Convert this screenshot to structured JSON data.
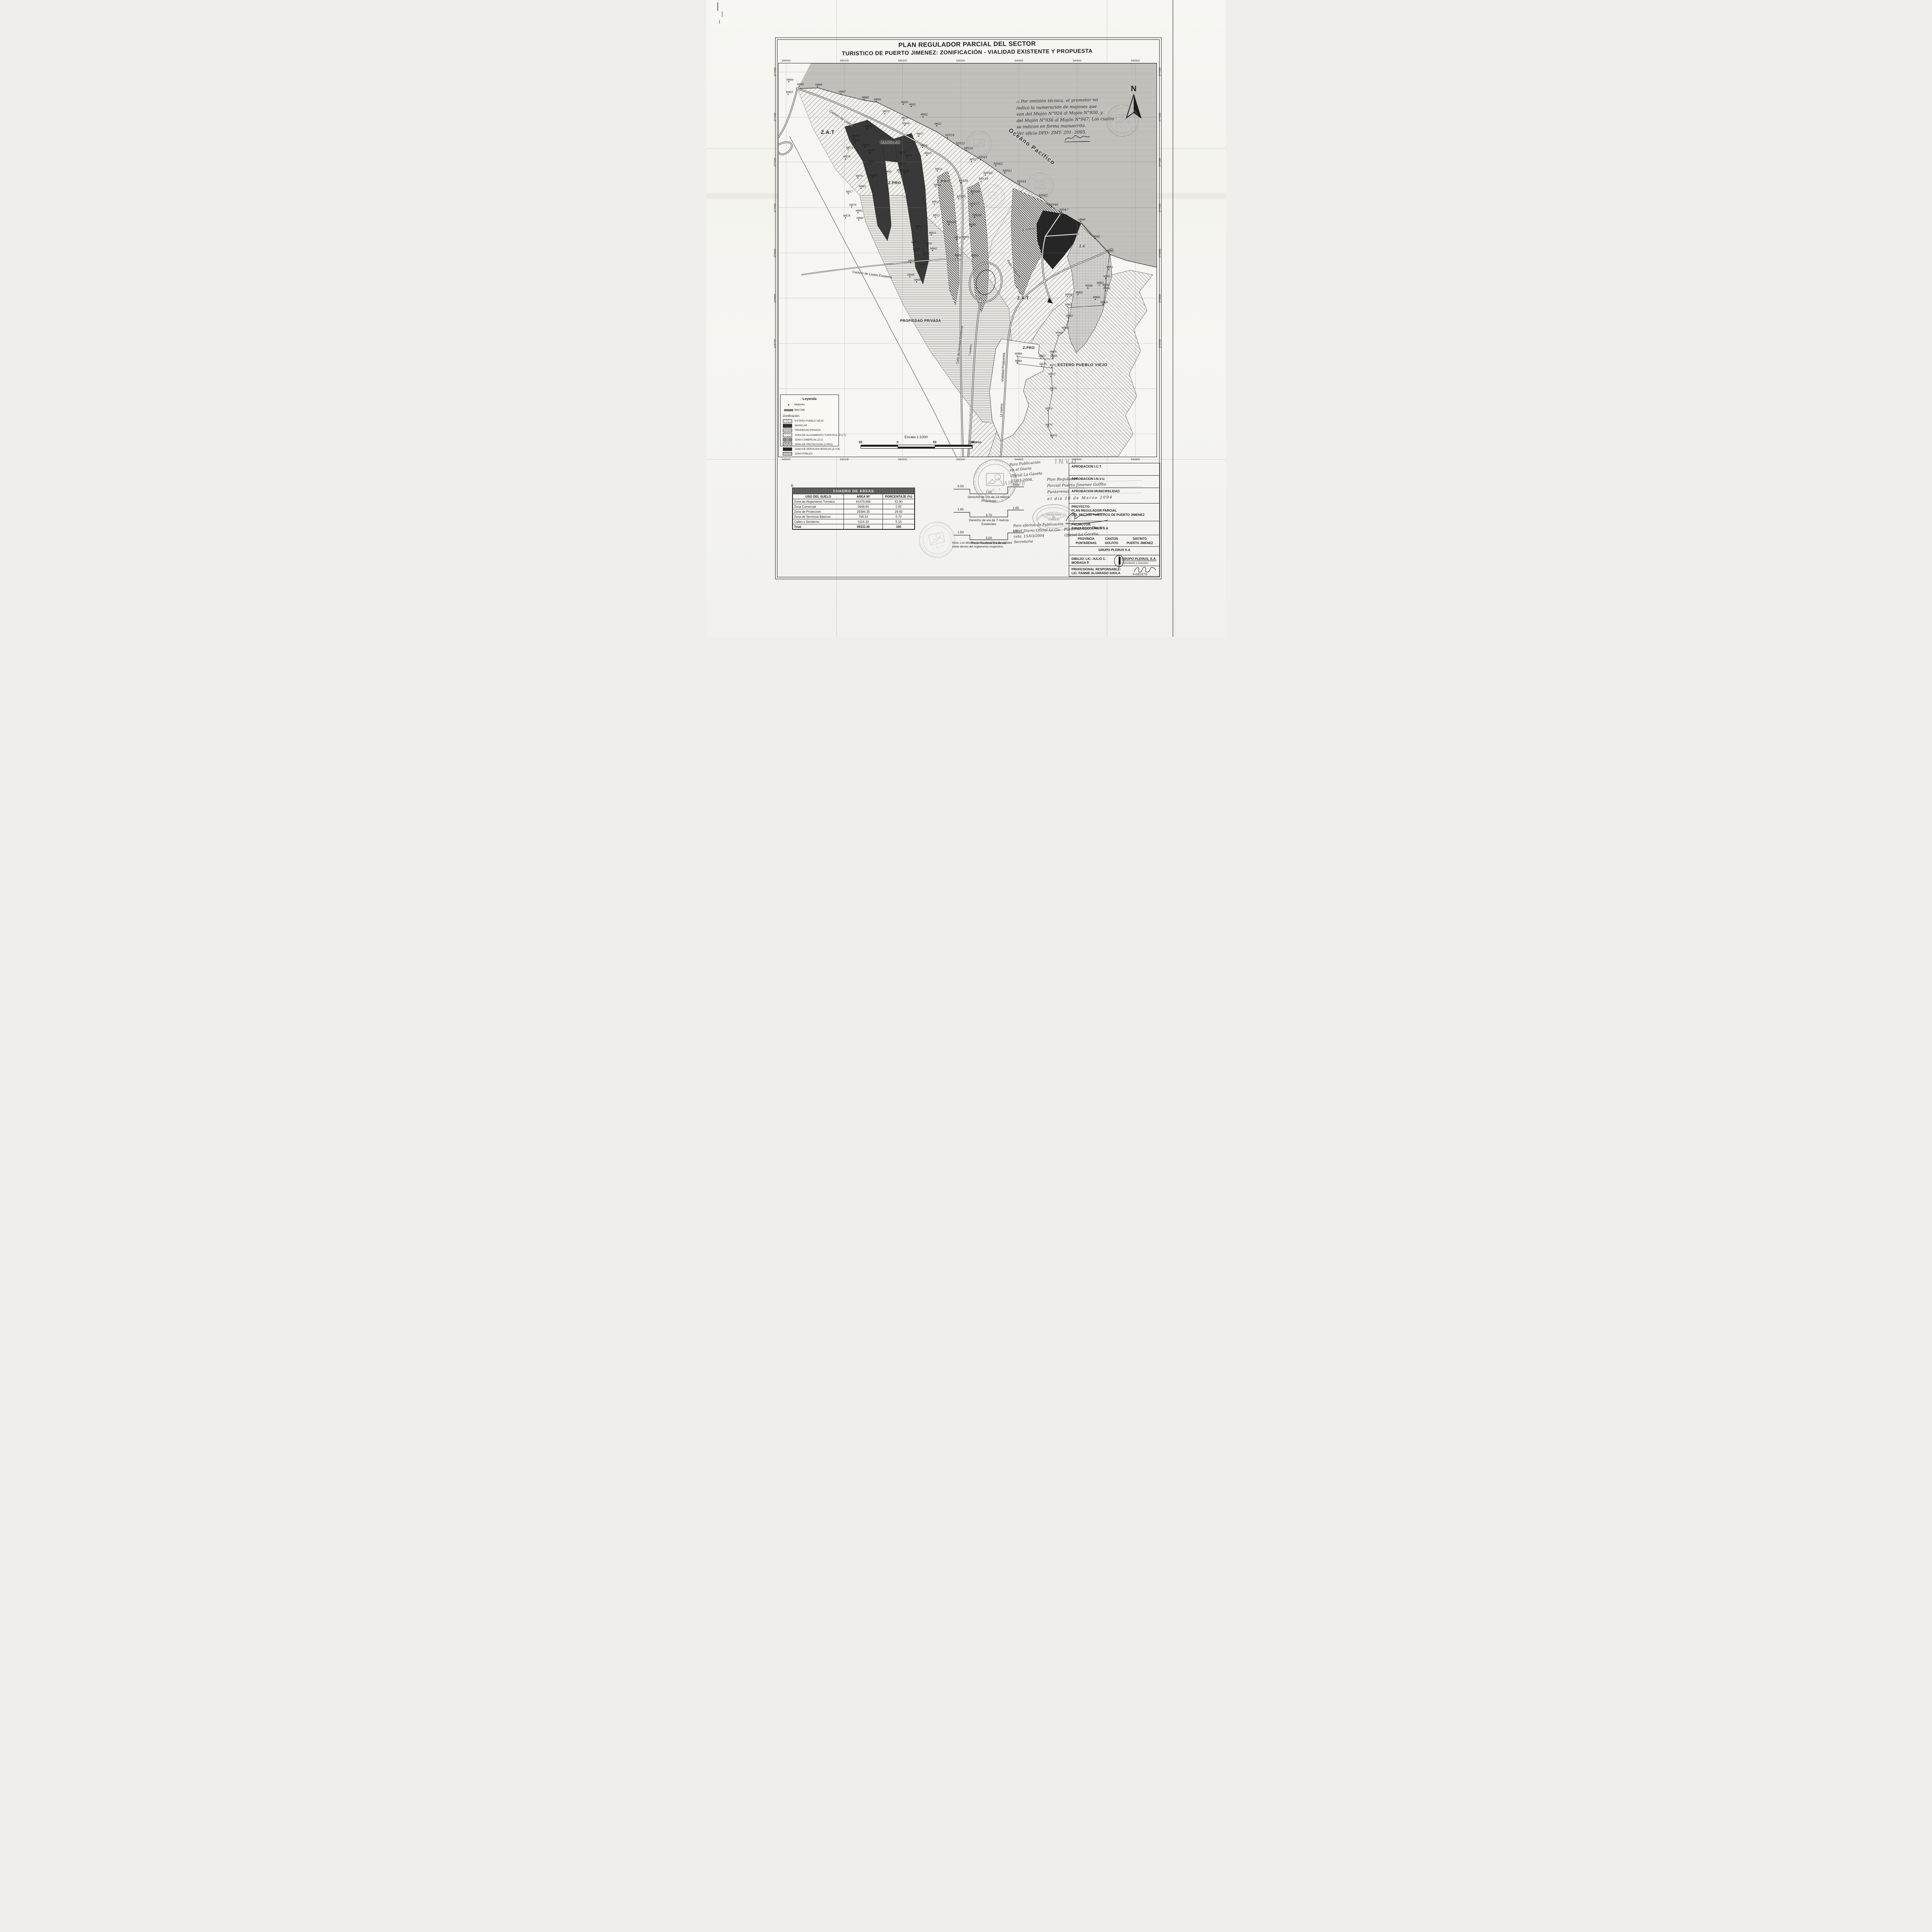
{
  "title": {
    "line1": "PLAN REGULADOR PARCIAL DEL SECTOR",
    "line2": "TURISTICO DE PUERTO JIMENEZ: ZONIFICACIÓN - VIALIDAD EXISTENTE Y PROPUESTA"
  },
  "map": {
    "ocean_label": "Oceáno Pacífico",
    "north_label": "N",
    "axis": {
      "x": [
        {
          "v": "540000",
          "p": 2
        },
        {
          "v": "540100",
          "p": 17.4
        },
        {
          "v": "540200",
          "p": 32.8
        },
        {
          "v": "540300",
          "p": 48.2
        },
        {
          "v": "540400",
          "p": 63.6
        },
        {
          "v": "540500",
          "p": 79
        },
        {
          "v": "540600",
          "p": 94.4
        }
      ],
      "y": [
        {
          "v": "277300",
          "p": 2.2
        },
        {
          "v": "277200",
          "p": 13.7
        },
        {
          "v": "277100",
          "p": 25.1
        },
        {
          "v": "277000",
          "p": 36.7
        },
        {
          "v": "276900",
          "p": 48.2
        },
        {
          "v": "276800",
          "p": 59.7
        },
        {
          "v": "276700",
          "p": 71.2
        },
        {
          "v": "",
          "p": 82.7
        },
        {
          "v": "",
          "p": 94.2
        }
      ]
    },
    "zone_labels": [
      {
        "t": "Z.A.T",
        "x": 13,
        "y": 17.5,
        "s": 13
      },
      {
        "t": "MANGLAR",
        "x": 29.5,
        "y": 20,
        "s": 9
      },
      {
        "t": "Z.PRO",
        "x": 30.7,
        "y": 30.5,
        "s": 10
      },
      {
        "t": "Z.PRO",
        "x": 43.6,
        "y": 30.1,
        "s": 10
      },
      {
        "t": "Z.C",
        "x": 80.4,
        "y": 46.5,
        "s": 9
      },
      {
        "t": "Z.A.T",
        "x": 64.7,
        "y": 59.7,
        "s": 11
      },
      {
        "t": "Z.PRO",
        "x": 66.2,
        "y": 72.3,
        "s": 9
      },
      {
        "t": "PROPIEDAD PRIVADA",
        "x": 37.6,
        "y": 65.4,
        "s": 9
      },
      {
        "t": "ESTERO PUEBLO VIEJO",
        "x": 80.4,
        "y": 76.7,
        "s": 10
      }
    ],
    "road_labels": [
      {
        "t": "Camino de Lastre",
        "x": 13.5,
        "y": 11.5,
        "r": 33,
        "s": 9
      },
      {
        "t": "Camino de Lastre Existente",
        "x": 19.5,
        "y": 52.5,
        "r": 8,
        "s": 8.5
      },
      {
        "t": "Calle de Servicio Existente",
        "x": 47.2,
        "y": 76,
        "r": -83,
        "s": 8.5
      },
      {
        "t": "Vialidad Propuesta",
        "x": 59.2,
        "y": 80.5,
        "r": -87,
        "s": 9
      },
      {
        "t": "Paso Peatonal",
        "x": 60.6,
        "y": 49.5,
        "r": 55,
        "s": 8.5
      },
      {
        "t": "6 metros",
        "x": 64.5,
        "y": 41.8,
        "r": -8,
        "s": 8.5
      },
      {
        "t": "7 metros",
        "x": 50.6,
        "y": 74,
        "r": -85,
        "s": 8
      },
      {
        "t": "14 metros",
        "x": 58.9,
        "y": 89.5,
        "r": -88,
        "s": 8
      },
      {
        "t": "Oceáno Pacífico",
        "x": 61,
        "y": 16,
        "r": 37,
        "s": 15,
        "ls": 2,
        "fw": 600
      }
    ],
    "note": {
      "mark": "◁",
      "lines": [
        "Por omisión técnica, el promotor no",
        "indicó la numeración de mojones que",
        "van del Mojón N°924 al Mojón N°930, y",
        "del Mojón N°936 al Mojón N°947; Los cuales",
        "se indican en forma manuscrita.",
        "Ver oficio DPD- ZMT- 291- 2005."
      ]
    },
    "mojones": [
      [
        "M863",
        2.7,
        8.1,
        0
      ],
      [
        "M864",
        2.9,
        4.9,
        0
      ],
      [
        "M865",
        5.6,
        6.1,
        0
      ],
      [
        "M866",
        10.5,
        6.2,
        0
      ],
      [
        "M867",
        16.7,
        8.0,
        0
      ],
      [
        "M868",
        22.8,
        9.4,
        0
      ],
      [
        "M869",
        26.0,
        9.9,
        0
      ],
      [
        "M870",
        28.3,
        13.0,
        0
      ],
      [
        "M871",
        23.6,
        16.8,
        0
      ],
      [
        "M872",
        20.1,
        19.3,
        0
      ],
      [
        "M873",
        20.4,
        20.4,
        0
      ],
      [
        "M874",
        18.6,
        22.2,
        0
      ],
      [
        "M875",
        17.9,
        24.5,
        0
      ],
      [
        "M876",
        21.2,
        29.4,
        0
      ],
      [
        "M877",
        18.6,
        33.4,
        0
      ],
      [
        "M878",
        17.9,
        39.5,
        0
      ],
      [
        "M879",
        19.5,
        36.7,
        0
      ],
      [
        "M880",
        21.4,
        40.1,
        0
      ],
      [
        "M881",
        21.2,
        38.2,
        0
      ],
      [
        "M882",
        40.9,
        47.8,
        0
      ],
      [
        "M883",
        22.0,
        32.0,
        0
      ],
      [
        "M884",
        25.0,
        29.3,
        0
      ],
      [
        "M885",
        24.4,
        25.7,
        0
      ],
      [
        "M886",
        23.0,
        21.5,
        0
      ],
      [
        "M893",
        32.0,
        27.9,
        0
      ],
      [
        "M894",
        32.4,
        26.1,
        0
      ],
      [
        "M895",
        28.8,
        28.3,
        0
      ],
      [
        "M896",
        24.3,
        22.9,
        0
      ],
      [
        "M897",
        33.5,
        28.2,
        0
      ],
      [
        "M898",
        32.6,
        23.4,
        0
      ],
      [
        "M899",
        34.3,
        24.2,
        0
      ],
      [
        "M901",
        36.9,
        42.1,
        0
      ],
      [
        "M902",
        35.9,
        46.3,
        0
      ],
      [
        "M903",
        36.3,
        47.9,
        0
      ],
      [
        "M904",
        35.1,
        50.9,
        0
      ],
      [
        "M905",
        34.9,
        54.5,
        0
      ],
      [
        "M906",
        36.7,
        55.8,
        0
      ],
      [
        "M907",
        38.1,
        52.0,
        0
      ],
      [
        "M908",
        38.8,
        49.0,
        0
      ],
      [
        "M909",
        39.5,
        46.6,
        0
      ],
      [
        "M910",
        40.6,
        43.8,
        0
      ],
      [
        "M911",
        41.6,
        39.4,
        0
      ],
      [
        "M912",
        41.4,
        36.0,
        0
      ],
      [
        "M913",
        41.8,
        31.6,
        0
      ],
      [
        "M914",
        42.2,
        27.6,
        0
      ],
      [
        "M915",
        39.4,
        23.6,
        0
      ],
      [
        "M916",
        38.3,
        21.6,
        0
      ],
      [
        "M917",
        37.3,
        18.7,
        0
      ],
      [
        "M918",
        33.6,
        16.0,
        0
      ],
      [
        "M919",
        33.3,
        14.6,
        0
      ],
      [
        "M920",
        33.2,
        10.6,
        0
      ],
      [
        "M921",
        35.3,
        11.2,
        0
      ],
      [
        "M922",
        38.4,
        13.8,
        0
      ],
      [
        "M923",
        42.0,
        16.1,
        0
      ],
      [
        "M924",
        45.1,
        19.1,
        1
      ],
      [
        "M925",
        47.9,
        21.1,
        1
      ],
      [
        "M926",
        50.1,
        22.4,
        1
      ],
      [
        "M927",
        51.5,
        25.2,
        1
      ],
      [
        "M928",
        48.7,
        30.6,
        1
      ],
      [
        "M929",
        48.1,
        34.7,
        1
      ],
      [
        "M930",
        45.5,
        41.2,
        1
      ],
      [
        "M931",
        47.3,
        45.0,
        0
      ],
      [
        "M932",
        47.4,
        49.5,
        0
      ],
      [
        "M933",
        51.8,
        49.6,
        0
      ],
      [
        "M934",
        49.4,
        44.9,
        0
      ],
      [
        "M935",
        51.2,
        41.7,
        0
      ],
      [
        "M936",
        52.3,
        39.4,
        1
      ],
      [
        "M937",
        51.6,
        36.5,
        1
      ],
      [
        "M938",
        51.8,
        33.4,
        1
      ],
      [
        "M939",
        54.0,
        30.2,
        1
      ],
      [
        "M940",
        55.2,
        28.7,
        1
      ],
      [
        "M941",
        53.9,
        24.7,
        1
      ],
      [
        "M942",
        57.9,
        26.3,
        1
      ],
      [
        "M943",
        60.3,
        28.1,
        1
      ],
      [
        "M944",
        64.1,
        30.8,
        1
      ],
      [
        "M945",
        69.8,
        34.4,
        1
      ],
      [
        "M946",
        72.6,
        36.7,
        1
      ],
      [
        "M947",
        75.3,
        38.0,
        1
      ],
      [
        "M948",
        80.1,
        40.5,
        0
      ],
      [
        "M949",
        83.9,
        44.8,
        0
      ],
      [
        "M950",
        87.6,
        48.4,
        0
      ],
      [
        "M951",
        87.5,
        52.6,
        0
      ],
      [
        "M952",
        86.7,
        54.9,
        0
      ],
      [
        "M953",
        86.7,
        58.0,
        0
      ],
      [
        "M954",
        86.0,
        61.5,
        0
      ],
      [
        "M955",
        84.0,
        60.2,
        0
      ],
      [
        "M956",
        86.5,
        57.1,
        0
      ],
      [
        "M957",
        85.0,
        56.6,
        0
      ],
      [
        "M958",
        82.0,
        57.3,
        0
      ],
      [
        "M959",
        79.4,
        59.0,
        0
      ],
      [
        "M960",
        76.6,
        59.5,
        0
      ],
      [
        "M961",
        76.6,
        62.1,
        0
      ],
      [
        "M962",
        76.8,
        64.9,
        0
      ],
      [
        "M963",
        75.7,
        68.0,
        0
      ],
      [
        "M964",
        74.1,
        69.3,
        0
      ],
      [
        "M965",
        72.5,
        74.1,
        0
      ],
      [
        "M966",
        72.7,
        75.1,
        0
      ],
      [
        "M967",
        69.6,
        75.1,
        0
      ],
      [
        "M968",
        63.3,
        74.6,
        0
      ],
      [
        "M969",
        63.3,
        76.4,
        0
      ],
      [
        "M970",
        69.8,
        77.2,
        0
      ],
      [
        "M971",
        72.5,
        77.5,
        0
      ],
      [
        "M972",
        72.2,
        79.8,
        0
      ],
      [
        "M973",
        72.5,
        83.4,
        0
      ],
      [
        "M974",
        71.4,
        88.5,
        0
      ],
      [
        "M975",
        71.4,
        92.6,
        0
      ],
      [
        "M976",
        72.6,
        95.4,
        0
      ]
    ]
  },
  "legend": {
    "title": "Leyenda",
    "mojones_label": "Mojones",
    "red_vial_label": "Red Vial",
    "zonification_title": "Zonificación",
    "items": [
      {
        "label": "ESTERO PUEBLO VIEJO",
        "key": "estero"
      },
      {
        "label": "MANGLAR",
        "key": "manglar"
      },
      {
        "label": "PROPIEDAD PRIVADA",
        "key": "priv"
      },
      {
        "label": "ZONA DE ALOJAMIENTO TURÍSTICO (Z.A.T)",
        "key": "zat"
      },
      {
        "label": "ZONA COMERCIAL (Z.C)",
        "key": "zc"
      },
      {
        "label": "ZONA DE PROTECCIÓN (Z.PRO)",
        "key": "zpro"
      },
      {
        "label": "ZONA DE SERVICIOS BÁSICOS (Z.S.B)",
        "key": "zsb"
      },
      {
        "label": "ZONA PÚBLICA",
        "key": "pub"
      }
    ]
  },
  "scalebar": {
    "title": "Escala 1:1000",
    "labels": [
      "50",
      "0",
      "50",
      "100"
    ],
    "unit": "metros"
  },
  "area_table": {
    "title": "CUADRO DE AREAS",
    "headers": [
      "USO DEL SUELO",
      "AREA M²",
      "PORCENTAJE (%)"
    ],
    "rows": [
      [
        "Zona de Alojamiento Turístico",
        "61479.666",
        "61.90"
      ],
      [
        "Zona Comercial",
        "2648.60",
        "2.65"
      ],
      [
        "Zona de Protección",
        "29384.35",
        "29.60"
      ],
      [
        "Zona de Servicios Básicos",
        "706.53",
        "0.70"
      ],
      [
        "Calles y Senderos",
        "5114.33",
        "5.15"
      ]
    ],
    "total_row": [
      "Total",
      "99333.46",
      "100"
    ]
  },
  "sections": {
    "items": [
      {
        "left": "3.50",
        "center": "7.00",
        "right": "3.50",
        "cap": [
          "Derecho de Vía de 14 metros",
          "Propuesta"
        ]
      },
      {
        "left": "1.65",
        "center": "3.70",
        "right": "1.65",
        "cap": [
          "Derecho de vía de 7 metros",
          "Existentes"
        ]
      },
      {
        "left": "1.50",
        "center": "3.00",
        "right": "1.50",
        "cap": [
          "Paso Peatonal Existente"
        ]
      }
    ],
    "note_line1": "Nota: Los detalles de los derechos de vialidad",
    "note_line2": "están dentro del reglamento respectivo."
  },
  "stamps": {
    "ict": {
      "ring": "DIRECCION DE PLANEAMIENTO Y DESARROLLO TURISTICO * ",
      "center": "I. C. T."
    },
    "muni": {
      "arc_top": "Municipalidad de Golfito",
      "line1": "SECRETARIA",
      "line2": "DE",
      "line3": "CONCEJO",
      "arc_bottom": "CONCEJO MUNICIPAL"
    },
    "invu": "INVU",
    "aprob": "APROB"
  },
  "annotations": {
    "hw1": [
      "Para Publicación",
      "en el Diario",
      "Oficial La Gaceta",
      "17-03-2004."
    ],
    "hw2": [
      "Plan Regulador",
      "Parcial Puerto Jimenez Golfito",
      "Puntarenas.",
      "el día 18 de Marzo 2004"
    ],
    "hw3": [
      "Para Publicar Diario",
      "Oficial La Gaceta."
    ],
    "hw4": [
      "Para efectos de Publicación",
      "en el Diario Oficial La Ga-",
      "ceta. 15/03/2004",
      "Secretaria"
    ],
    "corner_mark": "B"
  },
  "title_block": {
    "aprobaciones": [
      "APROBACION I.C.T.",
      "APROBACION I.N.V.U.",
      "APROBACION MUNICIPALIDAD"
    ],
    "proyecto_label": "PROYECTO:",
    "proyecto_lines": [
      "PLAN REGULADOR PARCIAL",
      "DEL SECTOR TURISTICO DE PUERTO JIMENEZ"
    ],
    "promotor_label": "PROMOTOR:",
    "promotor": "BAHIA COCODRILO S.A",
    "location_cols": [
      {
        "label": "PROVINCIA",
        "value": "PUNTARENAS"
      },
      {
        "label": "CANTON",
        "value": "GOLFITO"
      },
      {
        "label": "DISTRITO",
        "value": "PUERTO JIMENEZ"
      }
    ],
    "empresa": "GRUPO PLERUS S.A",
    "dibujo": "DIBUJO: LIC. JULIO C. MORAGA P.",
    "logo": {
      "line1": "GRUPO PLERUS, S.A.",
      "line2": "Consultores y Asesores"
    },
    "responsable_label": "PROFESIONAL RESPONSABLE:",
    "responsable": "LIC. FANNIE ALVARADO DAVLA",
    "responsable_sig": "9-082476"
  }
}
